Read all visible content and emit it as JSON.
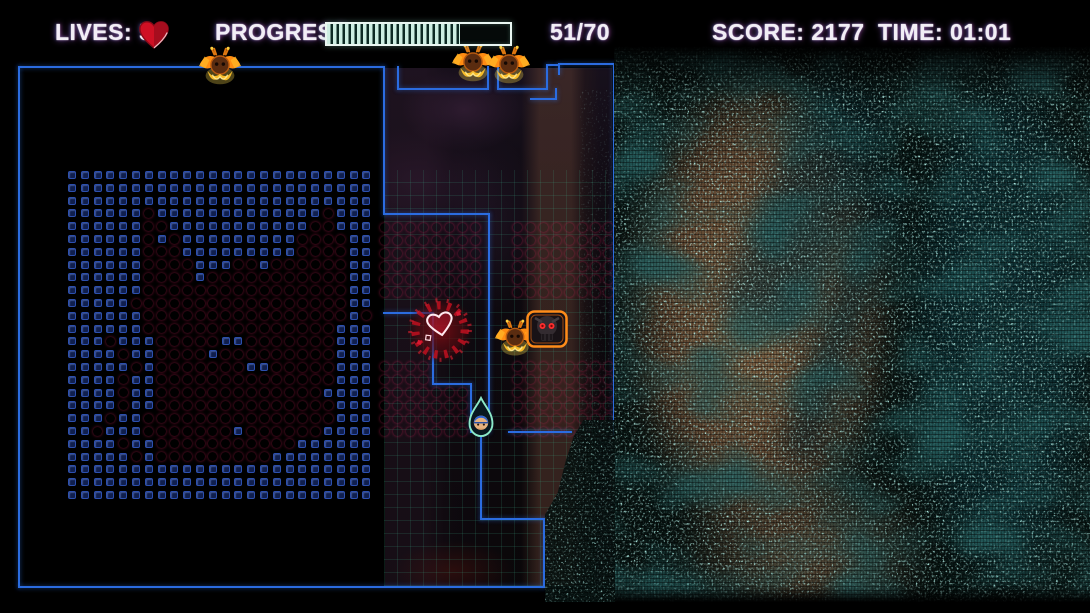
{
  "hud": {
    "lives_label": "LIVES:",
    "lives_value": "5",
    "progress_label": "PROGRESS:",
    "progress_current": 51,
    "progress_max": 70,
    "progress_text": "51/70",
    "score_label": "SCORE:",
    "score_value": "2177",
    "score_text": "SCORE: 2177",
    "time_label": "TIME:",
    "time_value": "01:01",
    "time_text": "TIME: 01:01"
  },
  "colors": {
    "wall_blue": "#2b6ce0",
    "dot_red": "#e31b5c",
    "brick_navy": "#101f4e",
    "hud_text": "#f2eef6",
    "progress_fill": "#cdeee2",
    "static_teal": "#8ce6d2",
    "heart_red": "#cf1024",
    "enemy_orange": "#ff9a1e",
    "player_outline_teal": "#8ce8c8"
  },
  "playfield": {
    "left_grid": {
      "x": 72,
      "y": 175,
      "pitch": 12.8,
      "pattern": [
        "........................",
        "........................",
        "........................",
        "......R.............R...",
        "......RR...........RR...",
        "......R.R.........RRRR..",
        "......RRR.........RRRR..",
        "......RRRR...RR.RRRRRR..",
        "......RRRR.RRRRRRRRRRR..",
        "......RRRRRRRRRRRRRRRR..",
        ".....RRRRRRRRRRRRRRRRR..",
        "......RRRRRRRRRRRRRRRR.R",
        "......RRRRRRRRRRRRRRR...",
        "...R...RRRRR..RRRRRRR...",
        "....R..RRRR.RRRRRRRRR...",
        ".....R.RRRRRRR..RRRRR...",
        "....R..RRRRRRRRRRRRRR...",
        "....R..RRRRRRRRRRRRR....",
        "....R..RRRRRRRRRRRRRR...",
        "...R..RRRRRRRRRRRRRRR...",
        "..R...RRRRRRR.RRRRRR....",
        "....R..RRRRRRRRRRR......",
        ".....R.RRRRRRRRR........",
        "........................",
        "........................",
        "........................"
      ]
    },
    "red_blocks": [
      {
        "name": "mid-upper-block",
        "x": 384,
        "y": 227,
        "cols": 8,
        "rows": 6,
        "pitch": 13
      },
      {
        "name": "right-upper-block",
        "x": 517,
        "y": 227,
        "cols": 8,
        "rows": 6,
        "pitch": 13
      },
      {
        "name": "mid-lower-block",
        "x": 384,
        "y": 366,
        "cols": 7,
        "rows": 6,
        "pitch": 13,
        "skip": [
          [
            0,
            4
          ],
          [
            0,
            5
          ],
          [
            0,
            6
          ],
          [
            1,
            4
          ],
          [
            1,
            5
          ],
          [
            1,
            6
          ]
        ]
      },
      {
        "name": "right-lower-block",
        "x": 517,
        "y": 366,
        "cols": 8,
        "rows": 6,
        "pitch": 13
      }
    ],
    "walls": [
      [
        18,
        66,
        2,
        522
      ],
      [
        18,
        66,
        367,
        2
      ],
      [
        18,
        586,
        527,
        2
      ],
      [
        383,
        66,
        2,
        149
      ],
      [
        383,
        213,
        107,
        2
      ],
      [
        488,
        213,
        2,
        220
      ],
      [
        397,
        66,
        2,
        24
      ],
      [
        397,
        88,
        92,
        2
      ],
      [
        487,
        66,
        2,
        24
      ],
      [
        497,
        66,
        2,
        24
      ],
      [
        497,
        88,
        51,
        2
      ],
      [
        546,
        64,
        2,
        26
      ],
      [
        546,
        64,
        12,
        2
      ],
      [
        555,
        88,
        2,
        12
      ],
      [
        530,
        98,
        27,
        2
      ],
      [
        558,
        63,
        57,
        2
      ],
      [
        558,
        63,
        2,
        12
      ],
      [
        613,
        63,
        2,
        372
      ],
      [
        383,
        312,
        51,
        2
      ],
      [
        432,
        312,
        2,
        73
      ],
      [
        432,
        383,
        40,
        2
      ],
      [
        470,
        383,
        2,
        50
      ],
      [
        508,
        431,
        64,
        2
      ],
      [
        480,
        431,
        10,
        2
      ],
      [
        480,
        431,
        2,
        89
      ],
      [
        480,
        518,
        65,
        2
      ],
      [
        543,
        518,
        2,
        70
      ]
    ],
    "sprites": [
      {
        "type": "bat",
        "x": 197,
        "y": 45,
        "w": 46,
        "h": 44
      },
      {
        "type": "bat",
        "x": 450,
        "y": 41,
        "w": 46,
        "h": 46
      },
      {
        "type": "bat",
        "x": 486,
        "y": 43,
        "w": 46,
        "h": 46
      },
      {
        "type": "bat",
        "x": 493,
        "y": 317,
        "w": 44,
        "h": 44
      },
      {
        "type": "skull",
        "x": 525,
        "y": 309,
        "w": 44,
        "h": 40
      },
      {
        "type": "burst",
        "x": 405,
        "y": 295,
        "w": 70,
        "h": 70
      },
      {
        "type": "player",
        "x": 466,
        "y": 396,
        "w": 30,
        "h": 42
      }
    ]
  }
}
